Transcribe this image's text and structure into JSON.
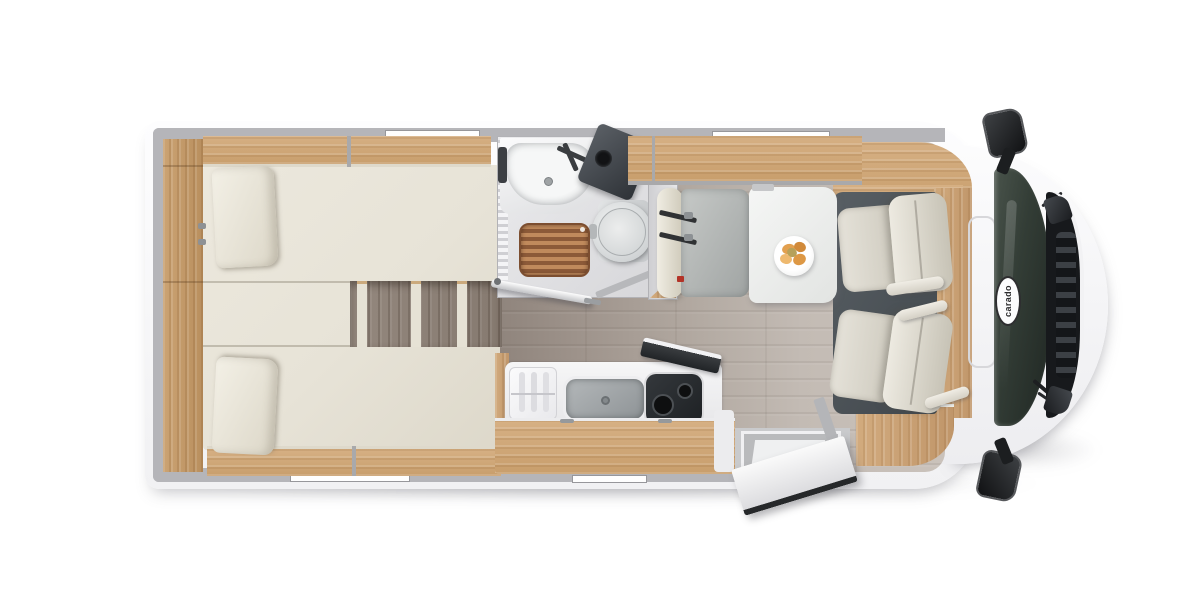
{
  "brand": {
    "label": "carado"
  },
  "vehicle": {
    "view": "top-down floor plan",
    "areas": {
      "bedroom": "twin-single-beds-rear",
      "bathroom": "wet-room-sink-toilet-shower",
      "kitchen": "kitchenette-sink-hob-fridge",
      "dinette": "half-dinette-bench-and-table",
      "cab": "driver-cab-two-swivel-seats",
      "entrance": "entry-door-open"
    }
  },
  "palette": {
    "body_white": "#fdfdfd",
    "wall_gray": "#b5b5b9",
    "wood_light_oak": "#cda87b",
    "mattress_cream": "#e9e5da",
    "floor_rear_wood": "#9a9088",
    "floor_living_wood": "#c6beb7",
    "cab_mat_dark": "#4d5358",
    "windshield_dark": "#2b332e",
    "shower_grate_teak": "#a5693f",
    "food_orange": "#e0a050",
    "seatbelt_dark": "#303234"
  }
}
